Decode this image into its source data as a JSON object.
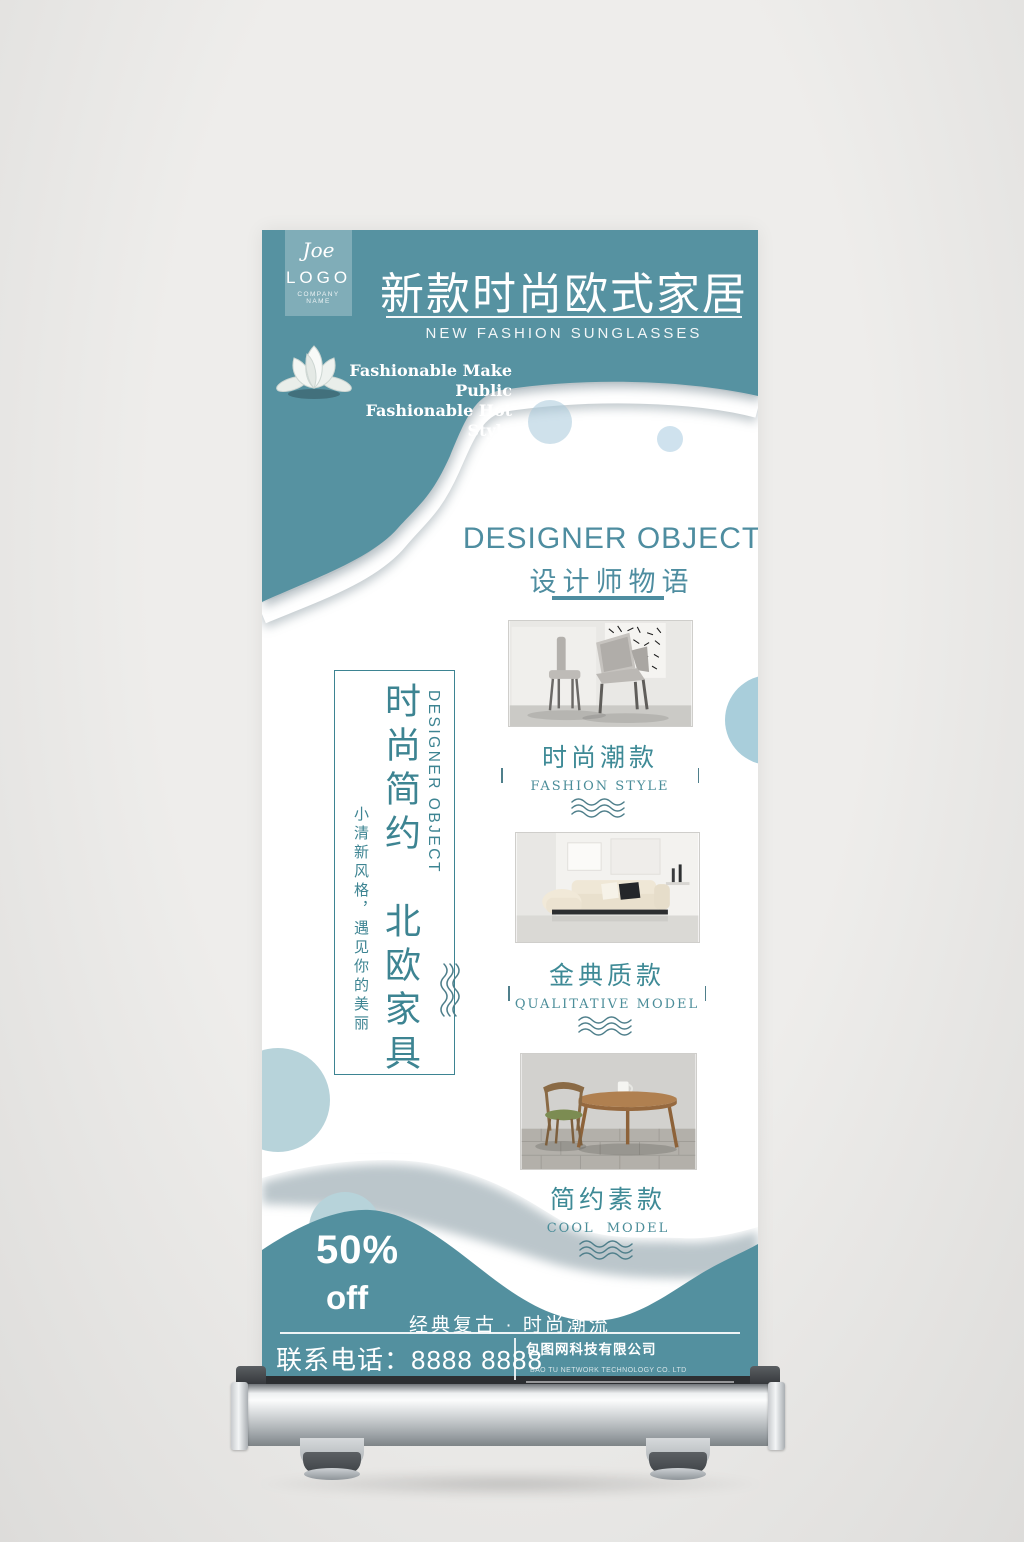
{
  "banner": {
    "logo": {
      "signature": "Joe",
      "name": "LOGO",
      "tagline": "COMPANY NAME"
    },
    "header": {
      "title": "新款时尚欧式家居",
      "subtitle": "NEW FASHION SUNGLASSES"
    },
    "slogan": {
      "line1": "Fashionable Make Public",
      "line2": "Fashionable Hot Style"
    },
    "section": {
      "title_en": "DESIGNER OBJECT",
      "title_zh": "设计师物语"
    },
    "products": [
      {
        "name_zh": "时尚潮款",
        "name_en": "FASHION STYLE"
      },
      {
        "name_zh": "金典质款",
        "name_en": "QUALITATIVE MODEL"
      },
      {
        "name_zh": "简约素款",
        "name_en": "COOL MODEL"
      }
    ],
    "vertical_panel": {
      "headline": "时尚简约　北欧家具",
      "side_en": "DESIGNER OBJECT",
      "subline": "小清新风格，遇见你的美丽"
    },
    "promo": {
      "percent": "50%",
      "unit": "off"
    },
    "footer": {
      "tagline": "经典复古 · 时尚潮流",
      "phone": "联系电话：8888 8888",
      "company_zh": "包图网科技有限公司",
      "company_en": "BAO TU NETWORK TECHNOLOGY CO. LTD"
    },
    "colors": {
      "teal": "#5692a1",
      "accent": "#3d8492",
      "light_circle": "#b7d3da"
    }
  }
}
